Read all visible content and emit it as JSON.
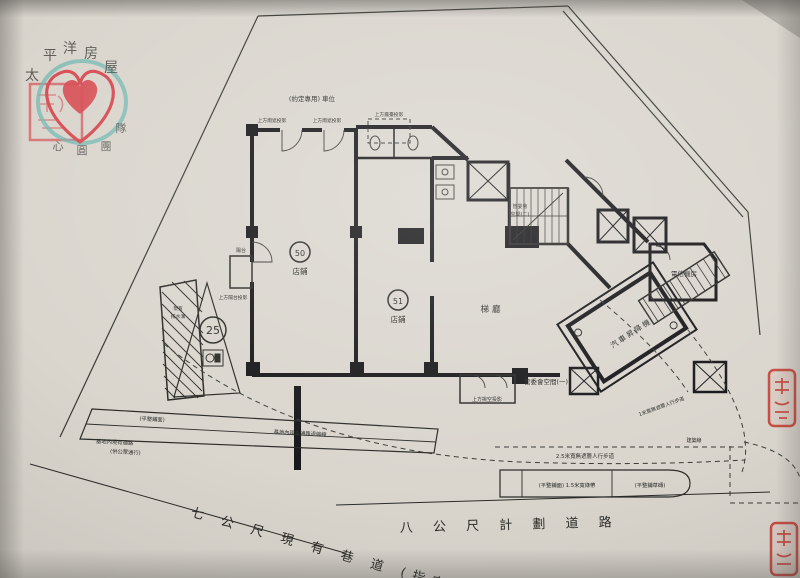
{
  "watermark": {
    "brand": [
      "太",
      "平",
      "洋",
      "房",
      "屋"
    ],
    "slogan": [
      "心",
      "圓",
      "團"
    ],
    "slogan_right": "隊"
  },
  "building": {
    "shop50_no": "50",
    "shop50_label": "店鋪",
    "shop51_no": "51",
    "shop51_label": "店鋪",
    "lobby": "梯廳",
    "telecom_room": "電信機房",
    "car_lift": "汽車昇降機",
    "mgmt_space_1": "管委會空間(一)",
    "mgmt_space_2_line1": "管委會",
    "mgmt_space_2_line2": "空間(二)",
    "balcony": "陽台"
  },
  "site_notes": {
    "parking_note": "(約定專用) 車位",
    "canopy_note_1": "上方雨遮投影",
    "canopy_note_2": "上方雨遮投影",
    "terrace_note": "上方露臺投影",
    "balcony_projection": "上方陽台投影",
    "void_note": "上方挑空投影",
    "ditch_line1": "現有",
    "ditch_line2": "排水溝",
    "plot_no": "25",
    "walkway_2_5m": "2.5米寬無遮簷人行步道",
    "walkway_1m": "1米寬無遮簷人行步道",
    "building_line": "建築線",
    "green_strip": "(平整鋪面) 1.5米寬綠帶",
    "grass_brick": "(平整鋪草磚)",
    "paving": "(平整鋪面)",
    "access_line1": "基地內現有通路",
    "access_line2": "(供公眾通行)",
    "setback_note": "基地內現有通路退縮線"
  },
  "roads": {
    "lane_7m": "七 公 尺 現 有 巷 道 (指定)",
    "road_8m": "八 公 尺 計 劃 道 路"
  },
  "colors": {
    "paper": "#dad6ce",
    "ink": "#2b2b28",
    "seal_red": "#c4372e",
    "brand_teal": "#5fb3ac",
    "brand_red": "#d7323c"
  }
}
